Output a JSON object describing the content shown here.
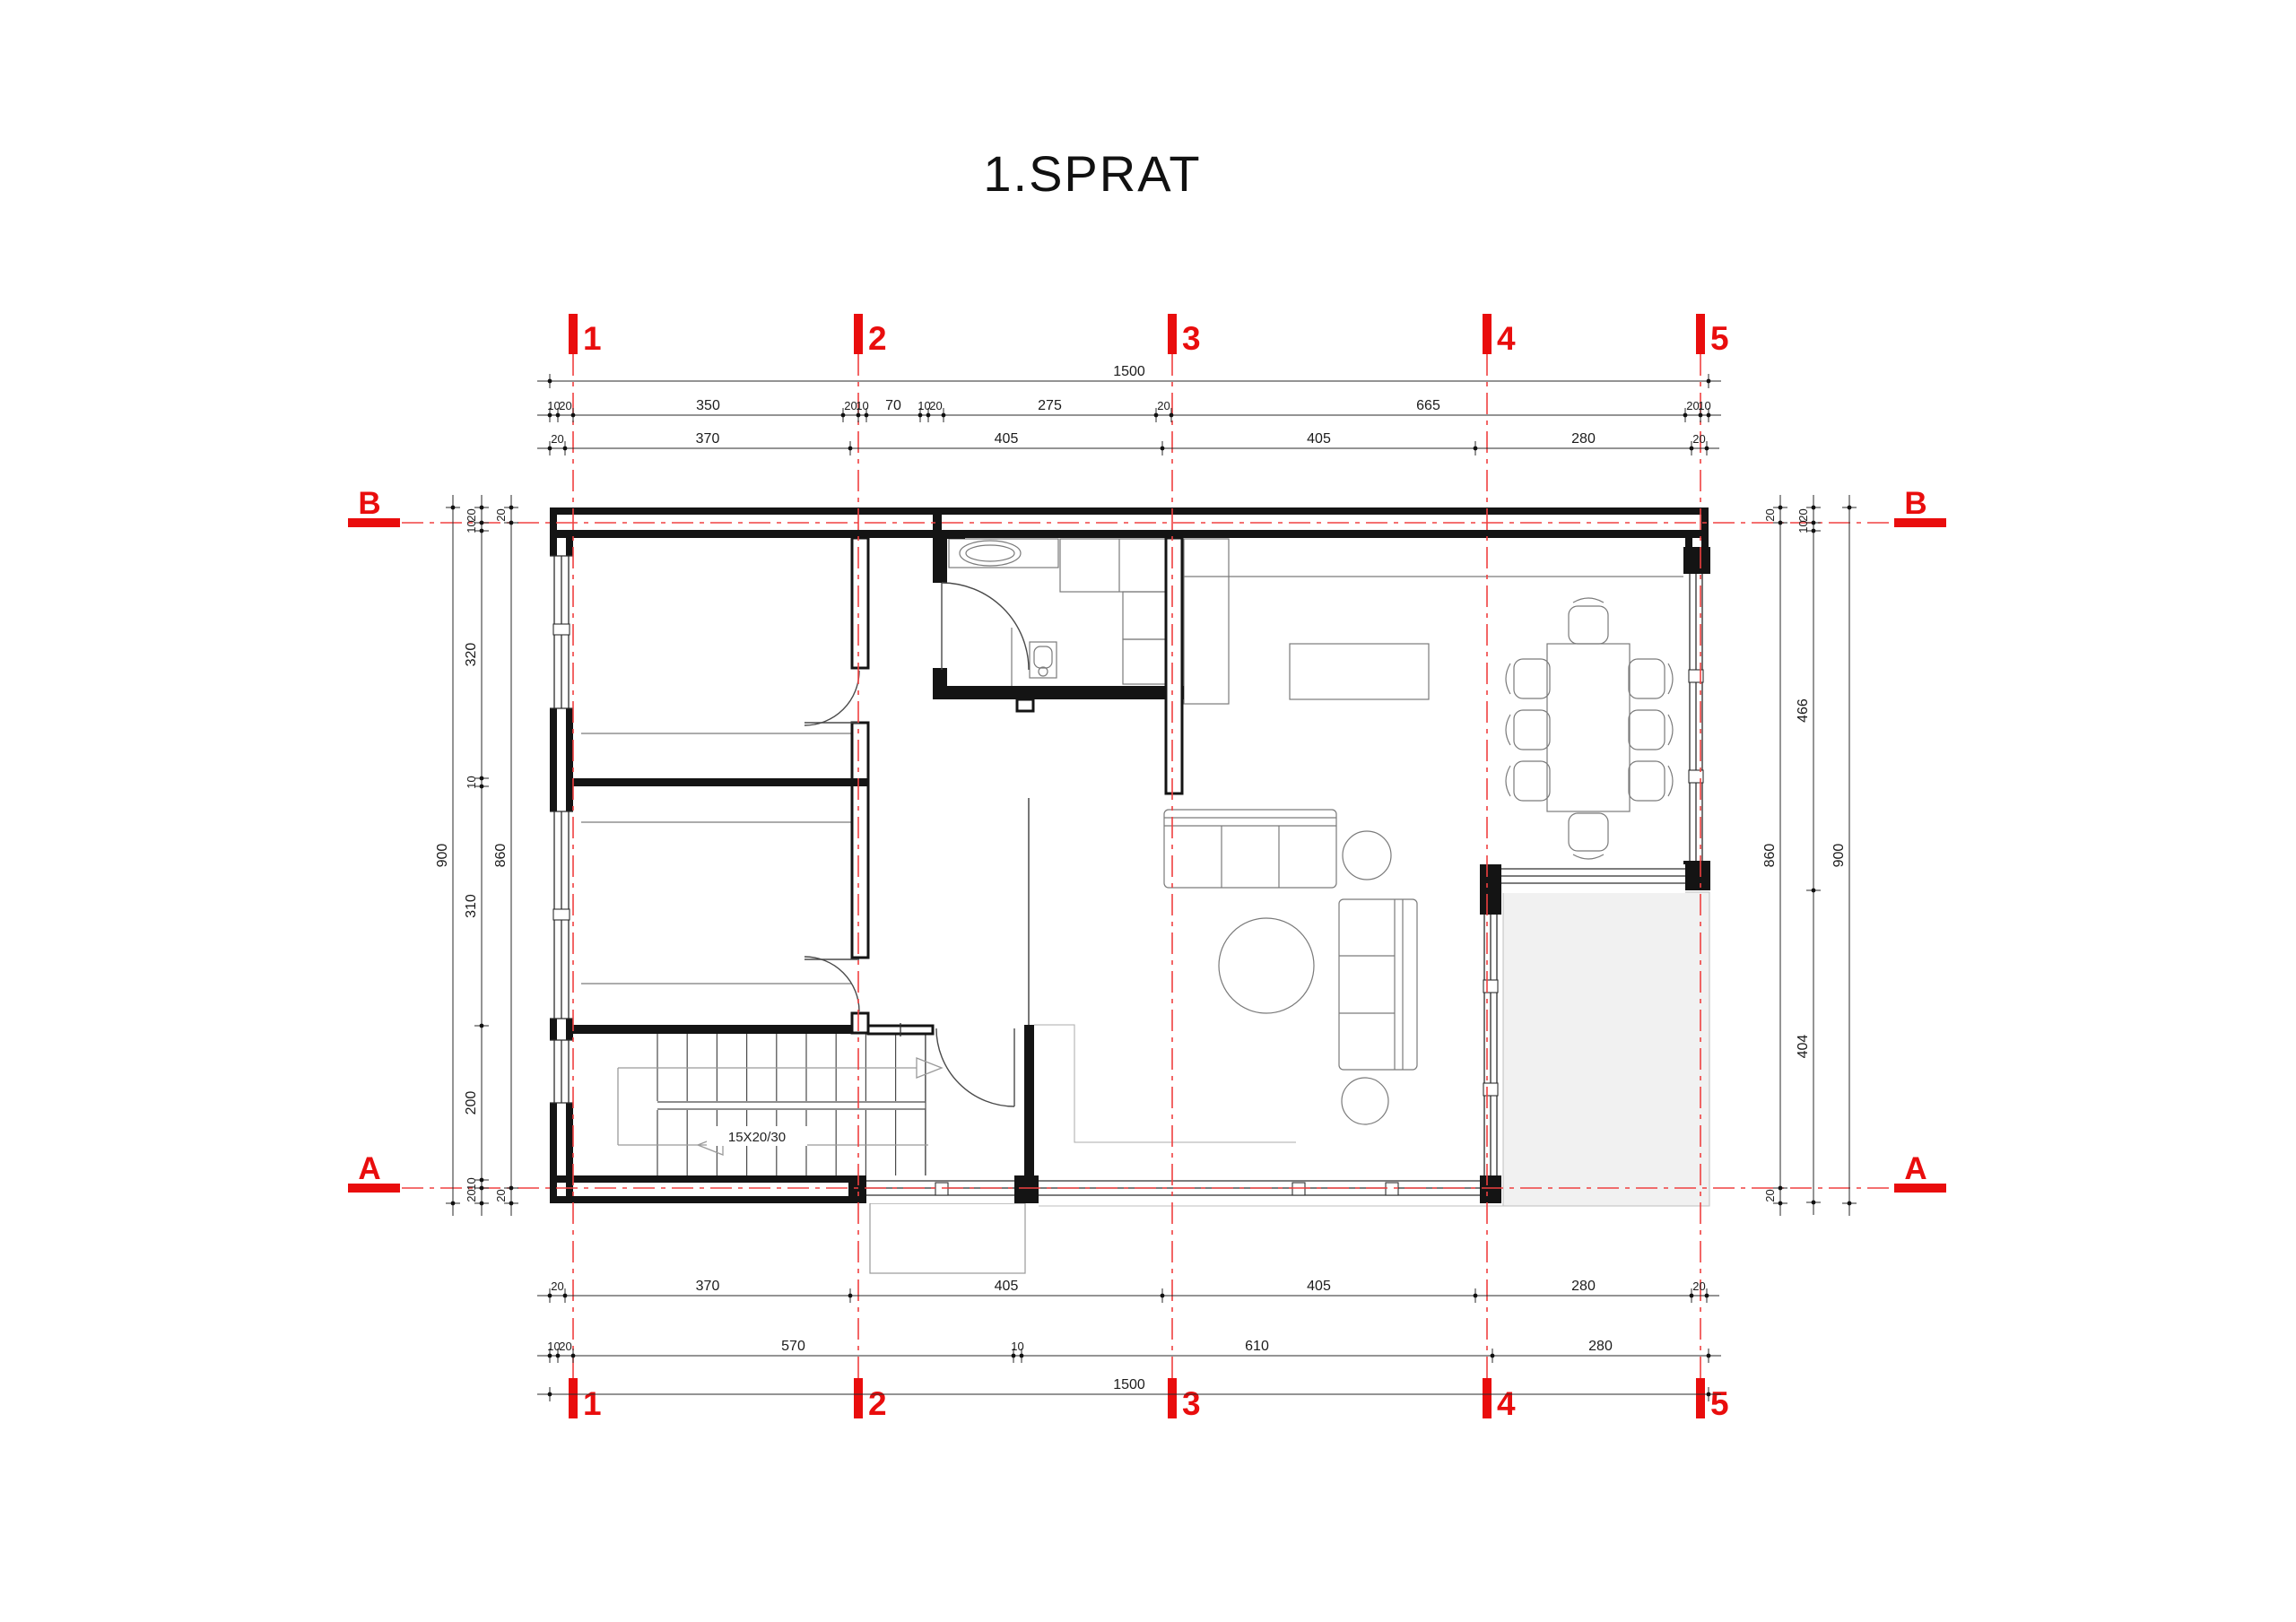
{
  "title": "1.SPRAT",
  "colors": {
    "marker_red": "#e90d0d",
    "axis_line_red": "#f04040",
    "wall_black": "#141414",
    "dim_color": "#1c1c1c",
    "furniture_grey": "#7a7a7a",
    "terrace_fill": "#f1f1f1"
  },
  "grid": {
    "columns": [
      {
        "label": "1"
      },
      {
        "label": "2"
      },
      {
        "label": "3"
      },
      {
        "label": "4"
      },
      {
        "label": "5"
      }
    ],
    "rows": [
      {
        "label": "B"
      },
      {
        "label": "A"
      }
    ]
  },
  "dimensions": {
    "top": {
      "row_overall": [
        "1500"
      ],
      "row_detail": [
        "10",
        "20",
        "350",
        "20",
        "10",
        "70",
        "10",
        "20",
        "275",
        "20",
        "665",
        "20",
        "10"
      ],
      "row_axes": [
        "20",
        "370",
        "405",
        "405",
        "280",
        "20"
      ]
    },
    "bottom": {
      "row_axes": [
        "20",
        "370",
        "405",
        "405",
        "280",
        "20"
      ],
      "row_detail": [
        "10",
        "20",
        "570",
        "10",
        "610",
        "280"
      ],
      "row_overall": [
        "1500"
      ]
    },
    "left": {
      "col_outer": [
        "900"
      ],
      "col_mid": [
        "20",
        "10",
        "320",
        "10",
        "310",
        "200",
        "10",
        "20"
      ],
      "col_inner": [
        "20",
        "860",
        "20"
      ]
    },
    "right": {
      "col_inner": [
        "20",
        "860",
        "20"
      ],
      "col_mid": [
        "20",
        "10",
        "466",
        "404"
      ],
      "col_outer": [
        "900"
      ]
    }
  },
  "stairs": {
    "label": "15X20/30"
  }
}
